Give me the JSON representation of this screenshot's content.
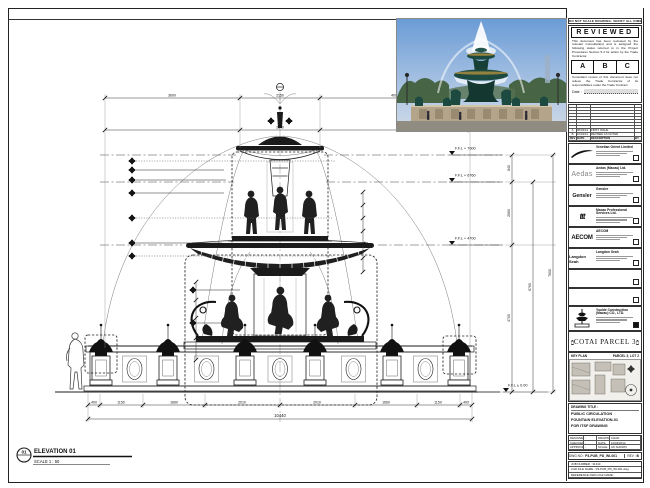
{
  "stamp": {
    "note": "DO NOT SCALE DRAWING. VERIFY ALL DIMENSIONS ON SITE.",
    "title": "REVIEWED",
    "para1": "This document has been reviewed by the relevant Consultant(s) and is assigned the following status referred to in the Project Procedures Section 5.4 for action by the Trade Contractor.",
    "options": [
      "A",
      "B",
      "C"
    ],
    "para2": "Consultant review of this document does not relieve the Trade Contractor of its responsibilities under the Trade Contract.",
    "date_label": "Date :"
  },
  "revision_table": {
    "headers": [
      "REV",
      "DATE",
      "DESCRIPTION",
      "BY"
    ],
    "entries": [
      {
        "rev": "A",
        "date": "05/03/14",
        "desc": "FIRST ISSUE",
        "by": ""
      },
      {
        "rev": "B",
        "date": "10/04/14",
        "desc": "REVISED AS NOTED",
        "by": ""
      }
    ]
  },
  "consultants": [
    {
      "name": "Venetian Orient Limited",
      "logo": ""
    },
    {
      "name": "Aedas (Macau) Ltd.",
      "logo": "Aedas"
    },
    {
      "name": "Gensler",
      "logo": "Gensler"
    },
    {
      "name": "Macau Professional Services Ltd.",
      "logo": "ttt"
    },
    {
      "name": "AECOM",
      "logo": "AECOM"
    },
    {
      "name": "Langdon Seah",
      "logo": "Langdon Seah"
    }
  ],
  "contractor": {
    "name": "Youlde Construction (Macau) CO., LTD."
  },
  "project": {
    "name": "COTAI PARCEL 3"
  },
  "key_plan": {
    "label": "KEY PLAN",
    "note": "PARCEL 3, LOT 2"
  },
  "title_block": {
    "label": "DRAWING TITLE :",
    "line1": "PUBLIC CIRCULATION",
    "line2": "FOUNTAIN ELEVATION-01",
    "line3": "FOR ITSF DRAWING",
    "designed_label": "DESIGNED",
    "designed": "-",
    "drawn_label": "DRAWN",
    "drawn": "CHAD",
    "checked_label": "CHECKED",
    "checked": "-",
    "date_label": "DATE",
    "date": "10/04/2014",
    "approved_label": "APPROVED",
    "approved": "-",
    "scale_label": "SCALE",
    "scale": "AS SHOWN",
    "dwg_no_label": "DWG NO :",
    "dwg_no": "P3-PUB_PD_WI-001",
    "rev_label": "REV :",
    "rev": "B",
    "job_label": "JOB NUMBER :",
    "job": "31310",
    "cad_label": "CAD FILE NAME :",
    "cad": "P3-PUB_PD_WI-001.dwg",
    "ref_label": "REFERENCE DWG FILE NAME :",
    "ref": ""
  },
  "drawing": {
    "levels": [
      "F.F.L + 7600",
      "F.F.L + 6760",
      "F.F.L + 4700",
      "F.F.L ± 0.00"
    ],
    "vdims": [
      "840",
      "2060",
      "4700",
      "6760",
      "7600"
    ],
    "top_dims": [
      "3600",
      "2150",
      "4000"
    ],
    "mid_dim": "2140",
    "bottom_dims": [
      "400",
      "1150",
      "1660",
      "2010",
      "2010",
      "1660",
      "1150",
      "400"
    ],
    "overall": "10440"
  },
  "elevation": {
    "bubble": "01",
    "label": "ELEVATION 01",
    "scale": "SCALE  1 : 50"
  }
}
